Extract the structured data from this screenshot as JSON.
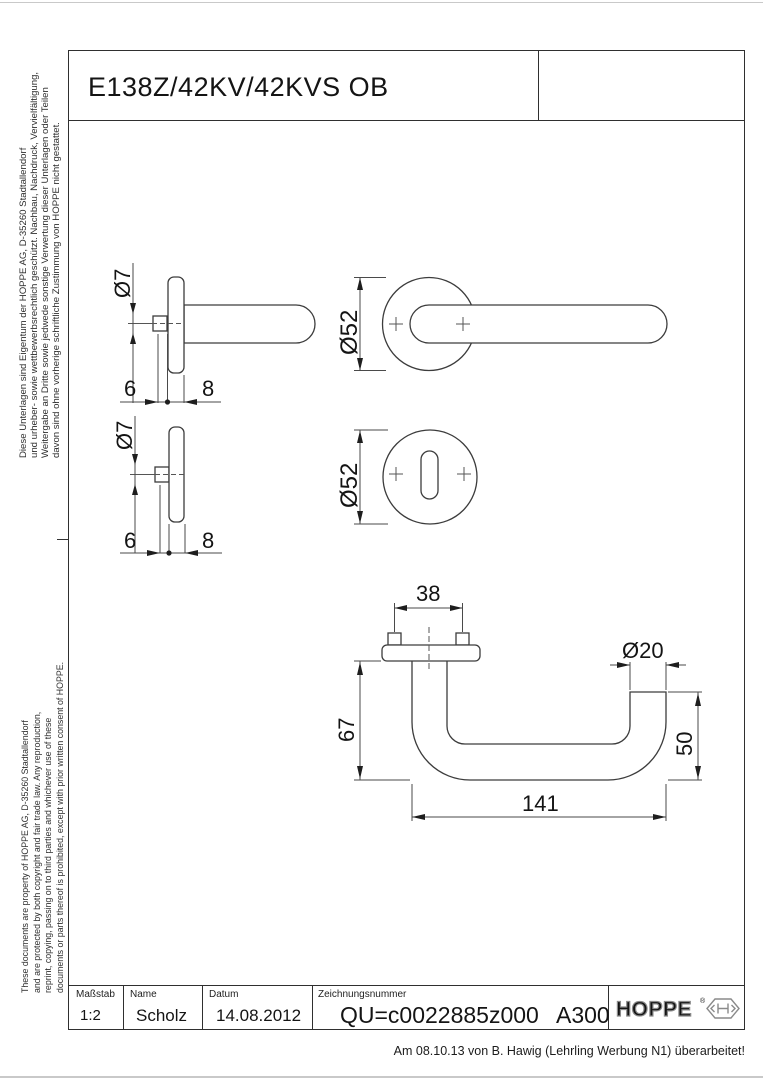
{
  "page": {
    "title": "E138Z/42KV/42KVS OB",
    "side_notes": {
      "german": [
        "Diese Unterlagen sind Eigentum der  HOPPE AG, D-35260 Stadtallendorf",
        "und urheber- sowie wettbewerbsrechtlich geschützt. Nachbau, Nachdruck, Vervielfältigung,",
        "Weitergabe an Dritte sowie jedwede sonstige Verwertung dieser Unterlagen oder Teilen",
        "davon sind ohne vorherige schriftliche Zustimmung von HOPPE nicht gestattet."
      ],
      "english": [
        "These documents are property of HOPPE AG, D-35260 Stadtallendorf",
        "and are protected by both copyright and fair trade law. Any reproduction,",
        "reprint, copying, passing on to third parties and whichever use of these",
        "documents or parts thereof is prohibited, except with prior written consent of HOPPE."
      ]
    }
  },
  "drawing": {
    "dims": {
      "phi7": "Ø7",
      "six": "6",
      "eight": "8",
      "phi52": "Ø52",
      "d38": "38",
      "phi20": "Ø20",
      "d67": "67",
      "d50": "50",
      "d141": "141"
    },
    "colors": {
      "line": "#3c3c3c",
      "dimension": "#4a4a4a",
      "text": "#141414"
    }
  },
  "title_block": {
    "scale_label": "Maßstab",
    "scale_value": "1:2",
    "name_label": "Name",
    "name_value": "Scholz",
    "date_label": "Datum",
    "date_value": "14.08.2012",
    "number_label": "Zeichnungsnummer",
    "number_value": "QU=c0022885z000",
    "revision": "A300",
    "logo_text": "HOPPE",
    "logo_reg": "®",
    "logo_color": "#8a8a8a"
  },
  "footer": {
    "revision_note": "Am 08.10.13 von B. Hawig (Lehrling Werbung N1) überarbeitet!"
  }
}
